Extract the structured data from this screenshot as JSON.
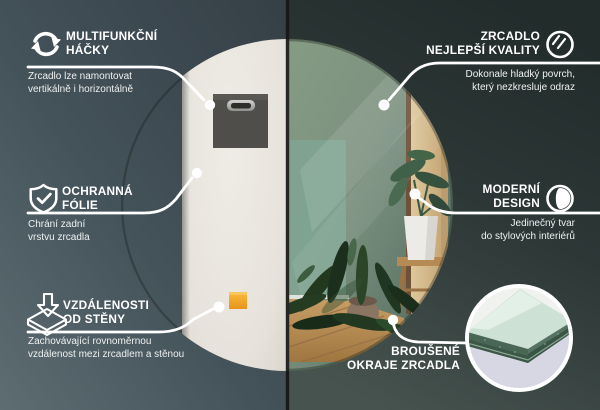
{
  "product": "round mirror infographic",
  "language": "cs",
  "callouts": {
    "hooks": {
      "title": [
        "MULTIFUNKČNÍ",
        "HÁČKY"
      ],
      "description": [
        "Zrcadlo lze namontovat",
        "vertikálně i horizontálně"
      ],
      "icon": "rotate-arrows-icon"
    },
    "quality": {
      "title": [
        "ZRCADLO",
        "NEJLEPŠÍ KVALITY"
      ],
      "description": [
        "Dokonale hladký povrch,",
        "který nezkresluje odraz"
      ],
      "icon": "mirror-shine-icon"
    },
    "foil": {
      "title": [
        "OCHRANNÁ",
        "FÓLIE"
      ],
      "description": [
        "Chrání zadní",
        "vrstvu zrcadla"
      ],
      "icon": "shield-check-icon"
    },
    "design": {
      "title": [
        "MODERNÍ",
        "DESIGN"
      ],
      "description": [
        "Jedinečný tvar",
        "do stylových interiérů"
      ],
      "icon": "contrast-circle-icon"
    },
    "distance": {
      "title": [
        "VZDÁLENOSTI",
        "OD STĚNY"
      ],
      "description": [
        "Zachovávající rovnoměrnou",
        "vzdálenost mezi zrcadlem a stěnou"
      ],
      "icon": "arrow-to-surface-icon"
    },
    "edges": {
      "title": [
        "BROUŠENÉ",
        "OKRAJE ZRCADLA"
      ],
      "icon": "edge-closeup-photo"
    }
  },
  "colors": {
    "background_left": "#46545a",
    "background_right": "#2a3534",
    "split_line": "#161616",
    "mirror_back": "#e9e6e0",
    "mirror_glass_green": "#7e9380",
    "hook_pad_gray": "#504e4a",
    "spacer_orange": "#f0a22a",
    "callout_line": "#ffffff",
    "wood_reflection": "#d3bd92",
    "floor_wood": "#b98e5c",
    "inset_glass_mint": "#cde1d5",
    "inset_edge_green": "#46604f",
    "inset_floor_lavender": "#d6d7e3"
  }
}
